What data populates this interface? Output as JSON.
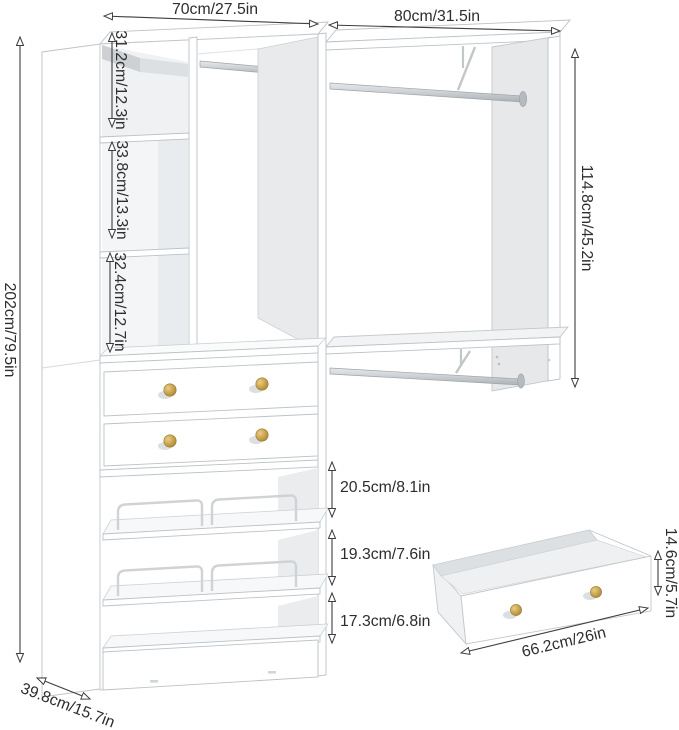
{
  "diagram": {
    "description": "Closet organizer / wardrobe dimension diagram with shelves, two hanging rods, two drawers, slanted shoe shelves and a separate pull-out drawer illustration",
    "background_color": "#ffffff",
    "furniture_color": "#ffffff",
    "panel_shadow_color": "#cdd1d4",
    "knob_color": "#c7a24d",
    "annotation_color": "#3d3d3d",
    "labels": {
      "left_section_width": "70cm/27.5in",
      "right_section_width": "80cm/31.5in",
      "overall_height": "202cm/79.5in",
      "cubby_top_height": "31.2cm/12.3in",
      "cubby_middle_height": "33.8cm/13.3in",
      "cubby_bottom_height": "32.4cm/12.7in",
      "right_section_height": "114.8cm/45.2in",
      "shelf_gap_top": "20.5cm/8.1in",
      "shelf_gap_middle": "19.3cm/7.6in",
      "shelf_gap_bottom": "17.3cm/6.8in",
      "pullout_drawer_width": "66.2cm/26in",
      "pullout_drawer_height": "14.6cm/5.7in",
      "unit_depth": "39.8cm/15.7in"
    }
  }
}
